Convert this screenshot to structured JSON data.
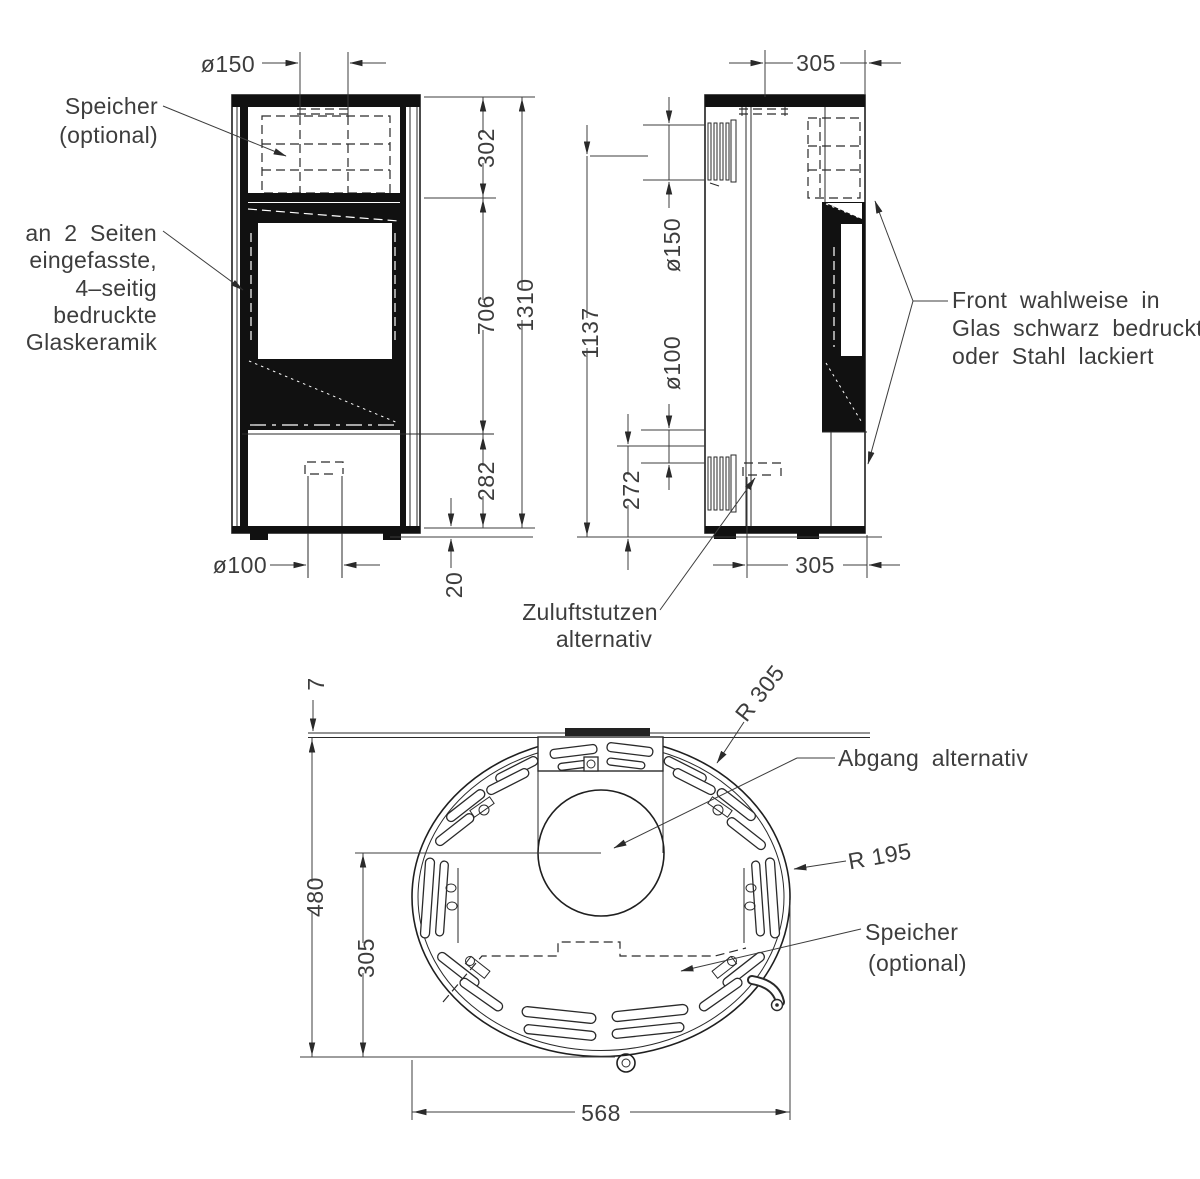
{
  "front_view": {
    "dim_flue_diameter": "ø150",
    "dim_top_section": "302",
    "dim_glass_section": "706",
    "dim_total_height": "1310",
    "dim_base_section": "282",
    "dim_foot_height": "20",
    "dim_air_diameter": "ø100",
    "label_storage_line1": "Speicher",
    "label_storage_line2": "(optional)",
    "label_glass_line1": "an 2 Seiten",
    "label_glass_line2": "eingefasste,",
    "label_glass_line3": "4–seitig",
    "label_glass_line4": "bedruckte",
    "label_glass_line5": "Glaskeramik"
  },
  "side_view": {
    "dim_flue_offset_top": "305",
    "dim_flue_diameter": "ø150",
    "dim_flue_height": "1137",
    "dim_air_diameter": "ø100",
    "dim_air_height": "272",
    "dim_air_offset_bottom": "305",
    "label_front_line1": "Front wahlweise in",
    "label_front_line2": "Glas schwarz bedruckt",
    "label_front_line3": "oder Stahl lackiert",
    "label_air_line1": "Zuluftstutzen",
    "label_air_line2": "alternativ"
  },
  "plan_view": {
    "dim_wall_gap": "7",
    "dim_depth": "480",
    "dim_flue_center_offset": "305",
    "dim_width": "568",
    "dim_front_radius": "R 305",
    "dim_side_radius": "R 195",
    "label_flue_alt": "Abgang alternativ",
    "label_storage_line1": "Speicher",
    "label_storage_line2": "(optional)"
  }
}
